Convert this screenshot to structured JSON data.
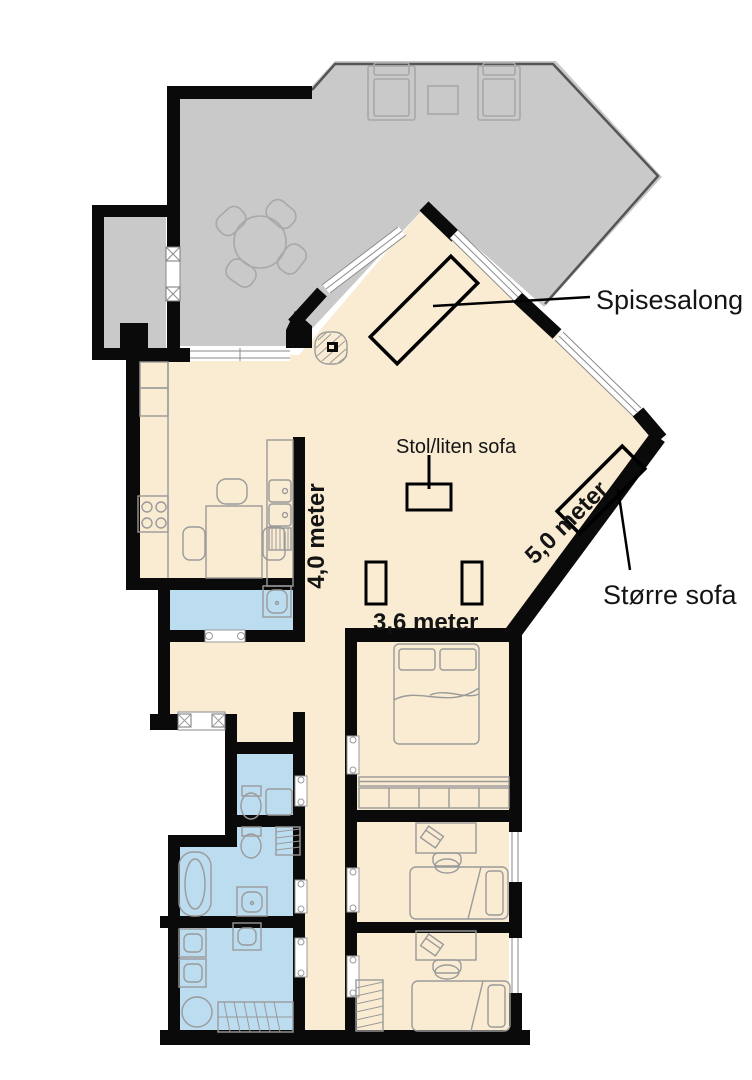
{
  "colors": {
    "terrace": "#c9c9c9",
    "floor": "#faecd3",
    "wet_room": "#bcdcf0",
    "wall": "#0a0a0a",
    "annotation": "#000000",
    "label_text": "#141414"
  },
  "labels": {
    "dining_area": "Spisesalong",
    "small_sofa": "Stol/liten sofa",
    "large_sofa": "Større sofa",
    "kitchen_wall_length": "4,0 meter",
    "diagonal_wall_length": "5,0 meter",
    "living_wall_length": "3,6 meter"
  }
}
